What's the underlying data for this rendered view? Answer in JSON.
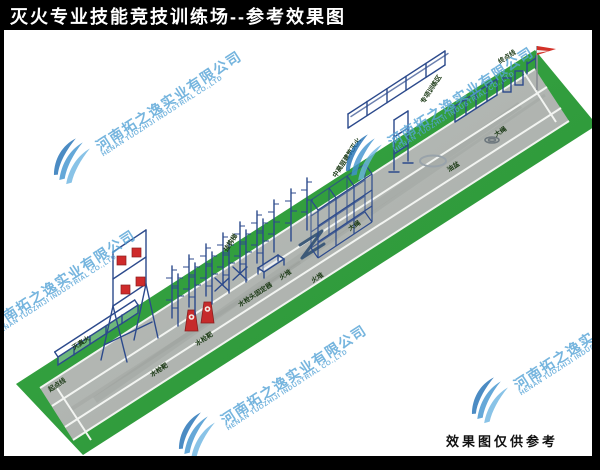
{
  "title": "灭火专业技能竞技训练场--参考效果图",
  "footer_note": "效果图仅供参考",
  "watermark": {
    "company_cn": "河南拓之逸实业有限公司",
    "company_en": "HENAN TUOZHIJI INDUSTRIAL CO.,LTD"
  },
  "colors": {
    "title_bg": "#000000",
    "title_fg": "#ffffff",
    "grass": "#2f9e3b",
    "track": "#afb4b0",
    "structure_blue": "#2c4a8c",
    "target_red": "#c62b2b",
    "watermark_blue": "#55a3d6",
    "label_green": "#1c3a16"
  },
  "scene": {
    "field_labels": [
      {
        "text": "终点线",
        "x": 500,
        "y": 64,
        "rot": -33
      },
      {
        "text": "大绳",
        "x": 496,
        "y": 137,
        "rot": -33
      },
      {
        "text": "油盆",
        "x": 449,
        "y": 172,
        "rot": -33
      },
      {
        "text": "专项训练区",
        "x": 424,
        "y": 104,
        "rot": -57
      },
      {
        "text": "中高层建筑灭火",
        "x": 336,
        "y": 178,
        "rot": -57
      },
      {
        "text": "大绳",
        "x": 350,
        "y": 231,
        "rot": -33
      },
      {
        "text": "火堆",
        "x": 281,
        "y": 280,
        "rot": -33
      },
      {
        "text": "火堆",
        "x": 313,
        "y": 283,
        "rot": -33
      },
      {
        "text": "水枪头固定器",
        "x": 240,
        "y": 307,
        "rot": -33
      },
      {
        "text": "挂钩梯",
        "x": 227,
        "y": 252,
        "rot": -57
      },
      {
        "text": "水枪靶",
        "x": 197,
        "y": 346,
        "rot": -33
      },
      {
        "text": "水枪靶",
        "x": 152,
        "y": 377,
        "rot": -33
      },
      {
        "text": "灭真火",
        "x": 74,
        "y": 350,
        "rot": -33
      },
      {
        "text": "起点线",
        "x": 50,
        "y": 392,
        "rot": -33
      }
    ]
  }
}
